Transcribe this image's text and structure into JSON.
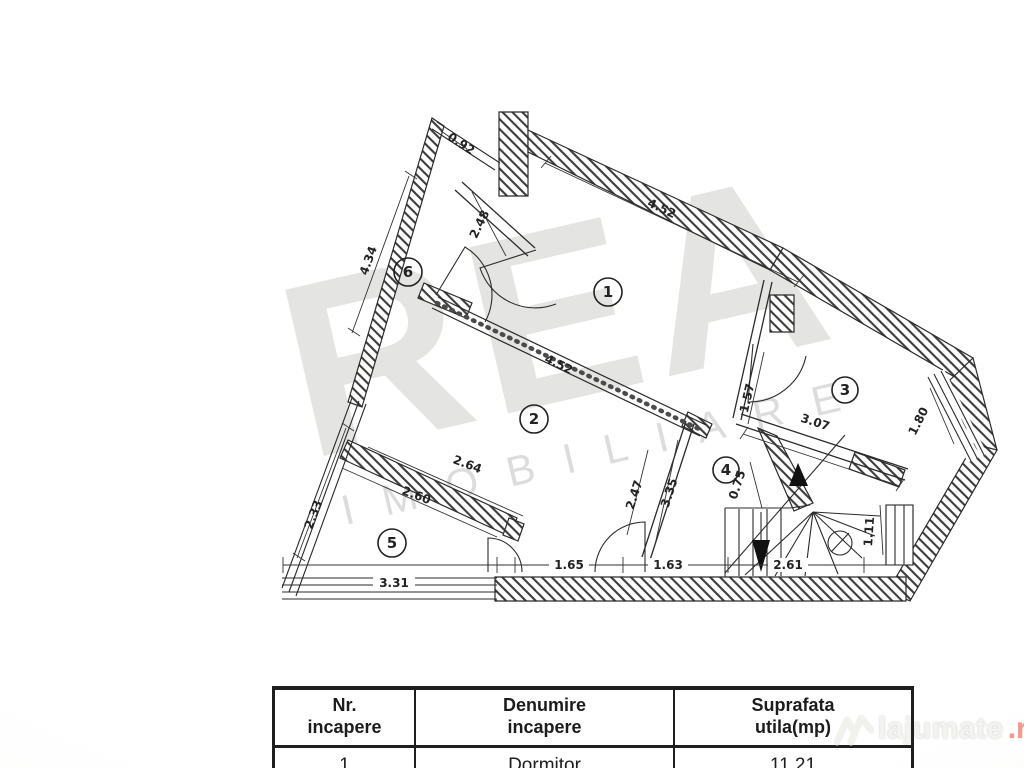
{
  "watermark": {
    "brand": "REA",
    "subtitle": "IMOBILIARE"
  },
  "site_watermark": {
    "name": "lajumate",
    "tld": ".ro"
  },
  "plan": {
    "rooms": {
      "r1": "1",
      "r2": "2",
      "r3": "3",
      "r4": "4",
      "r5": "5",
      "r6": "6"
    },
    "dims": {
      "d092": "0.92",
      "d248": "2.48",
      "d434": "4.34",
      "d452a": "4.52",
      "d452b": "4.52",
      "d157": "1.57",
      "d307": "3.07",
      "d180": "1.80",
      "d335": "3.35",
      "d247": "2.47",
      "d264": "2.64",
      "d260": "2.60",
      "d233": "2.33",
      "d331": "3.31",
      "d165": "1.65",
      "d163": "1.63",
      "d261": "2.61",
      "d075": "0.75",
      "d111": "1.11"
    }
  },
  "table": {
    "headers": [
      {
        "line1": "Nr.",
        "line2": "incapere"
      },
      {
        "line1": "Denumire",
        "line2": "incapere"
      },
      {
        "line1": "Suprafata",
        "line2": "utila(mp)"
      }
    ],
    "rows": [
      {
        "nr": "1",
        "denumire": "Dormitor",
        "suprafata": "11.21"
      }
    ]
  }
}
